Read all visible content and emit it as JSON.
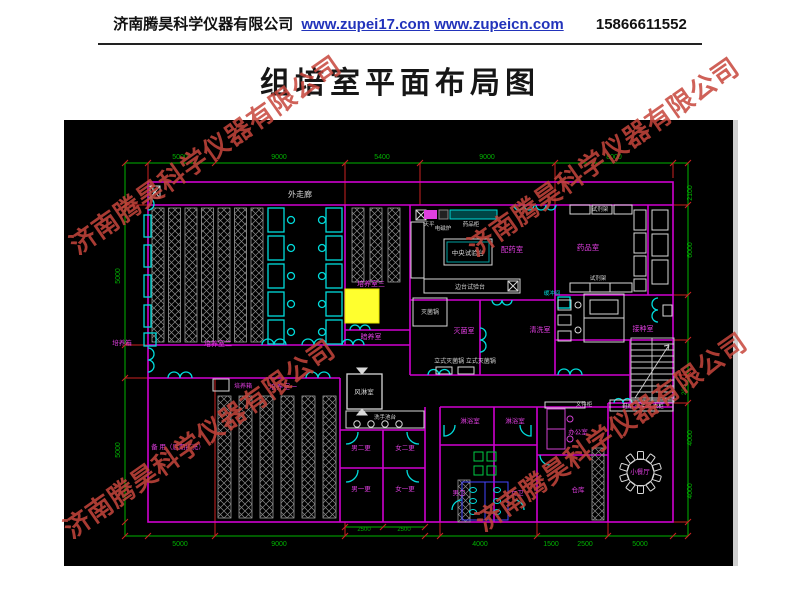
{
  "header": {
    "company": "济南腾昊科学仪器有限公司",
    "url1": "www.zupei17.com",
    "url2": "www.zupeicn.com",
    "phone": "15866611552"
  },
  "title": "组培室平面布局图",
  "watermark": {
    "text": "济南腾昊科学仪器有限公司",
    "color": "#c7463c"
  },
  "plan": {
    "background": "#000000",
    "colors": {
      "m": "#e13ee1",
      "w": "#d6d6d6",
      "c": "#00dcdc",
      "g": "#00b300",
      "y": "#ffff2e"
    },
    "labels": [
      {
        "t": "外走廊",
        "x": 300,
        "y": 197,
        "c": "w",
        "s": 8
      },
      {
        "t": "中央试验台",
        "x": 468,
        "y": 255,
        "c": "w",
        "s": 6.5
      },
      {
        "t": "边台试验台",
        "x": 470,
        "y": 289,
        "c": "w",
        "s": 6
      },
      {
        "t": "灭菌锅",
        "x": 430,
        "y": 314,
        "c": "w",
        "s": 6
      },
      {
        "t": "立式灭菌锅 立式灭菌锅",
        "x": 465,
        "y": 363,
        "c": "w",
        "s": 6
      },
      {
        "t": "风淋室",
        "x": 364,
        "y": 394,
        "c": "w",
        "s": 6.5
      },
      {
        "t": "洗手池台",
        "x": 385,
        "y": 419,
        "c": "w",
        "s": 5.5
      },
      {
        "t": "试剂架",
        "x": 600,
        "y": 211,
        "c": "w",
        "s": 5.5
      },
      {
        "t": "试剂架",
        "x": 598,
        "y": 280,
        "c": "w",
        "s": 5.5
      },
      {
        "t": "天平",
        "x": 429,
        "y": 226,
        "c": "w",
        "s": 5.5
      },
      {
        "t": "电磁炉",
        "x": 443,
        "y": 230,
        "c": "w",
        "s": 5.5
      },
      {
        "t": "药品柜",
        "x": 471,
        "y": 226,
        "c": "w",
        "s": 5.5
      },
      {
        "t": "文件柜",
        "x": 584,
        "y": 406,
        "c": "w",
        "s": 5.5
      },
      {
        "t": "鞋柜 洗手池 衣柜",
        "x": 643,
        "y": 408,
        "c": "w",
        "s": 5.5
      },
      {
        "t": "培养室三",
        "x": 371,
        "y": 286,
        "c": "m",
        "s": 7
      },
      {
        "t": "培养室二",
        "x": 218,
        "y": 346,
        "c": "m",
        "s": 7
      },
      {
        "t": "培养箱",
        "x": 122,
        "y": 345,
        "c": "m",
        "s": 6.5
      },
      {
        "t": "暗养室",
        "x": 371,
        "y": 339,
        "c": "m",
        "s": 7
      },
      {
        "t": "培养室一",
        "x": 283,
        "y": 389,
        "c": "m",
        "s": 7
      },
      {
        "t": "培养箱",
        "x": 243,
        "y": 388,
        "c": "m",
        "s": 6
      },
      {
        "t": "备 用（后期扩充）",
        "x": 178,
        "y": 449,
        "c": "m",
        "s": 6.5
      },
      {
        "t": "配药室",
        "x": 512,
        "y": 252,
        "c": "m",
        "s": 7.5
      },
      {
        "t": "药品室",
        "x": 588,
        "y": 250,
        "c": "m",
        "s": 7.5
      },
      {
        "t": "灭菌室",
        "x": 464,
        "y": 333,
        "c": "m",
        "s": 7
      },
      {
        "t": "清洗室",
        "x": 540,
        "y": 332,
        "c": "m",
        "s": 7
      },
      {
        "t": "接种室",
        "x": 643,
        "y": 331,
        "c": "m",
        "s": 7
      },
      {
        "t": "缓冲间",
        "x": 552,
        "y": 295,
        "c": "c",
        "s": 5.5
      },
      {
        "t": "男二更",
        "x": 361,
        "y": 450,
        "c": "m",
        "s": 6.5
      },
      {
        "t": "女二更",
        "x": 405,
        "y": 450,
        "c": "m",
        "s": 6.5
      },
      {
        "t": "男一更",
        "x": 361,
        "y": 491,
        "c": "m",
        "s": 6.5
      },
      {
        "t": "女一更",
        "x": 405,
        "y": 491,
        "c": "m",
        "s": 6.5
      },
      {
        "t": "淋浴室",
        "x": 470,
        "y": 423,
        "c": "m",
        "s": 6.5
      },
      {
        "t": "淋浴室",
        "x": 515,
        "y": 423,
        "c": "m",
        "s": 6.5
      },
      {
        "t": "男卫",
        "x": 459,
        "y": 495,
        "c": "m",
        "s": 6.5
      },
      {
        "t": "女卫",
        "x": 517,
        "y": 495,
        "c": "m",
        "s": 6.5
      },
      {
        "t": "办公室",
        "x": 578,
        "y": 434,
        "c": "m",
        "s": 6.5
      },
      {
        "t": "仓库",
        "x": 578,
        "y": 492,
        "c": "m",
        "s": 6.5
      },
      {
        "t": "小餐厅",
        "x": 640,
        "y": 474,
        "c": "m",
        "s": 6.5
      },
      {
        "t": "5000",
        "x": 180,
        "y": 159,
        "c": "g",
        "s": 7
      },
      {
        "t": "9000",
        "x": 279,
        "y": 159,
        "c": "g",
        "s": 7
      },
      {
        "t": "5400",
        "x": 382,
        "y": 159,
        "c": "g",
        "s": 7
      },
      {
        "t": "9000",
        "x": 487,
        "y": 159,
        "c": "g",
        "s": 7
      },
      {
        "t": "8000",
        "x": 614,
        "y": 159,
        "c": "g",
        "s": 7
      },
      {
        "t": "5000",
        "x": 180,
        "y": 546,
        "c": "g",
        "s": 7
      },
      {
        "t": "9000",
        "x": 279,
        "y": 546,
        "c": "g",
        "s": 7
      },
      {
        "t": "4000",
        "x": 480,
        "y": 546,
        "c": "g",
        "s": 7
      },
      {
        "t": "1500",
        "x": 551,
        "y": 546,
        "c": "g",
        "s": 7
      },
      {
        "t": "2500",
        "x": 585,
        "y": 546,
        "c": "g",
        "s": 7
      },
      {
        "t": "5000",
        "x": 640,
        "y": 546,
        "c": "g",
        "s": 7
      },
      {
        "t": "2500",
        "x": 364,
        "y": 531,
        "c": "g",
        "s": 6
      },
      {
        "t": "2500",
        "x": 404,
        "y": 531,
        "c": "g",
        "s": 6
      },
      {
        "t": "5000",
        "x": 120,
        "y": 276,
        "c": "g",
        "s": 7,
        "r": -90
      },
      {
        "t": "5000",
        "x": 120,
        "y": 450,
        "c": "g",
        "s": 7,
        "r": -90
      },
      {
        "t": "2100",
        "x": 692,
        "y": 193,
        "c": "g",
        "s": 7,
        "r": -90
      },
      {
        "t": "6000",
        "x": 692,
        "y": 250,
        "c": "g",
        "s": 7,
        "r": -90
      },
      {
        "t": "200",
        "x": 686,
        "y": 390,
        "c": "g",
        "s": 6,
        "r": -90
      },
      {
        "t": "4000",
        "x": 692,
        "y": 438,
        "c": "g",
        "s": 7,
        "r": -90
      },
      {
        "t": "4000",
        "x": 692,
        "y": 491,
        "c": "g",
        "s": 7,
        "r": -90
      }
    ]
  }
}
